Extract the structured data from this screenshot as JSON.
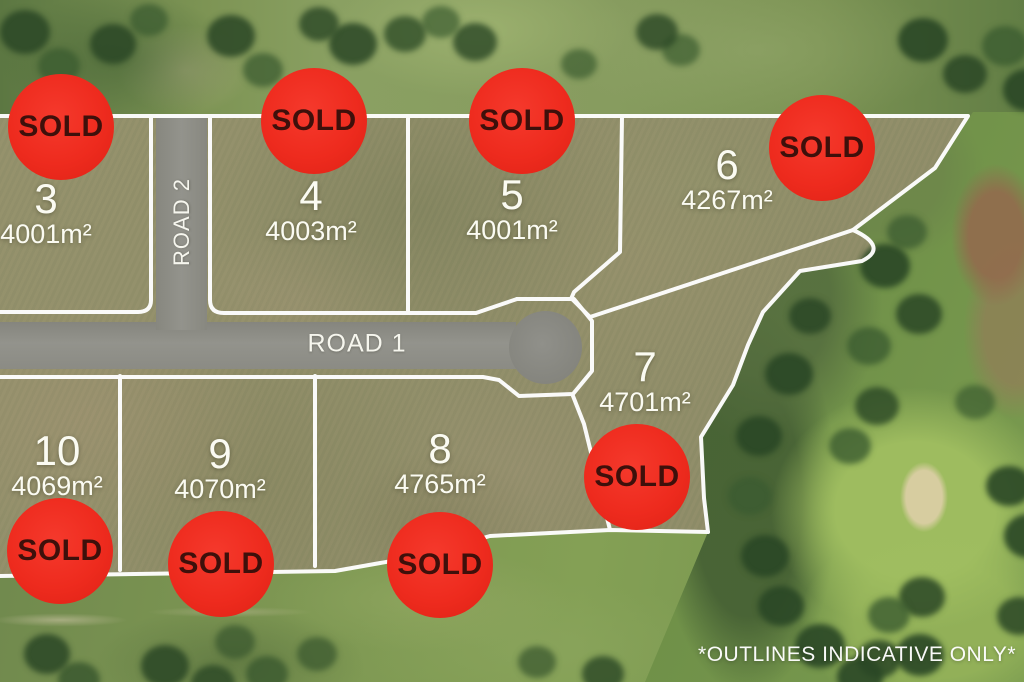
{
  "scene": {
    "type": "aerial-subdivision-sales-map",
    "disclaimer": "*OUTLINES INDICATIVE ONLY*"
  },
  "roads": {
    "road1": {
      "name": "ROAD 1"
    },
    "road2": {
      "name": "ROAD 2"
    }
  },
  "lots": {
    "lot3": {
      "number": "3",
      "area": "4001m²",
      "status": "SOLD"
    },
    "lot4": {
      "number": "4",
      "area": "4003m²",
      "status": "SOLD"
    },
    "lot5": {
      "number": "5",
      "area": "4001m²",
      "status": "SOLD"
    },
    "lot6": {
      "number": "6",
      "area": "4267m²",
      "status": "SOLD"
    },
    "lot7": {
      "number": "7",
      "area": "4701m²",
      "status": "SOLD"
    },
    "lot8": {
      "number": "8",
      "area": "4765m²",
      "status": "SOLD"
    },
    "lot9": {
      "number": "9",
      "area": "4070m²",
      "status": "SOLD"
    },
    "lot10": {
      "number": "10",
      "area": "4069m²",
      "status": "SOLD"
    }
  },
  "colors": {
    "sold_badge_bg": "#ee2b1e",
    "sold_badge_text": "#3e100b",
    "boundary_line": "#ffffff",
    "road_surface": "#8e8e87",
    "label_text": "#fbfbf2"
  }
}
